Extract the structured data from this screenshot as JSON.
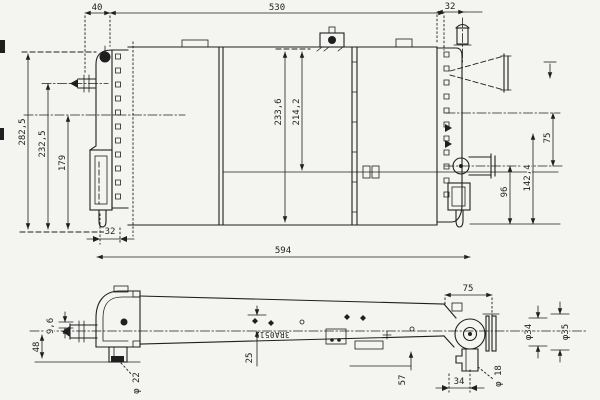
{
  "drawing": {
    "type": "two-view radiator engineering line drawing",
    "colors": {
      "line": "#1f1f1f",
      "paper": "#f4f4f1"
    },
    "front": {
      "dim_top_offset": "40",
      "dim_top_span": "530",
      "dim_top_right": "32",
      "dim_left_outer": "282,5",
      "dim_left_mid": "232,5",
      "dim_left_inner": "179",
      "dim_center_left": "233,6",
      "dim_center_right": "214,2",
      "dim_right_upper": "75",
      "dim_right_mid": "142,4",
      "dim_right_lower": "96",
      "dim_bracket": "32",
      "dim_overall": "594"
    },
    "top": {
      "dim_pipe": "9,6",
      "dim_bracket_height": "48",
      "dim_pin": "φ 22",
      "dim_core": "25",
      "stamp": "3RA0512",
      "dim_offset": "57",
      "dim_right_span": "75",
      "dim_conn_inner": "φ34",
      "dim_conn_outer": "φ35",
      "dim_hole": "φ 18",
      "dim_tank": "34"
    }
  }
}
